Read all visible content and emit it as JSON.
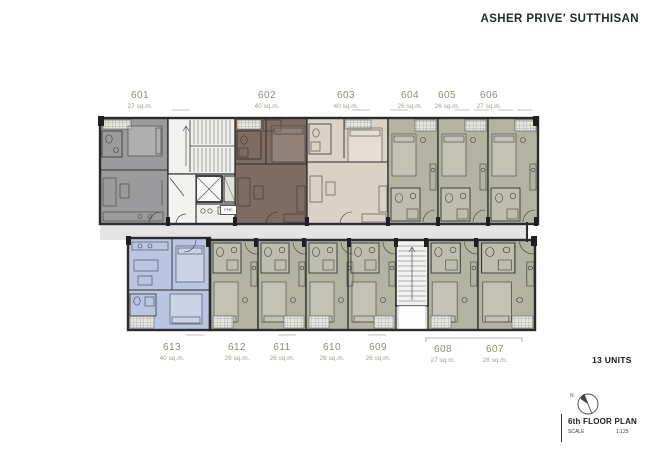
{
  "header": {
    "title": "ASHER PRIVE' SUTTHISAN"
  },
  "plan": {
    "fhc_label": "FHC",
    "units": [
      {
        "number": "601",
        "area": "27 sq.m."
      },
      {
        "number": "602",
        "area": "40 sq.m."
      },
      {
        "number": "603",
        "area": "40 sq.m."
      },
      {
        "number": "604",
        "area": "26 sq.m."
      },
      {
        "number": "605",
        "area": "26 sq.m."
      },
      {
        "number": "606",
        "area": "27 sq.m."
      },
      {
        "number": "607",
        "area": "28 sq.m."
      },
      {
        "number": "608",
        "area": "27 sq.m."
      },
      {
        "number": "609",
        "area": "26 sq.m."
      },
      {
        "number": "610",
        "area": "26 sq.m."
      },
      {
        "number": "611",
        "area": "26 sq.m."
      },
      {
        "number": "612",
        "area": "26 sq.m."
      },
      {
        "number": "613",
        "area": "40 sq.m."
      }
    ]
  },
  "compass": {
    "label": "N"
  },
  "footer": {
    "units_count": "13 UNITS",
    "plan_title": "6th FLOOR PLAN",
    "scale_label": "SCALE",
    "scale_value": "1:125"
  },
  "colors": {
    "unit_601": "#9b9b9d",
    "unit_602": "#7e6c62",
    "unit_603": "#d9d3c7",
    "unit_studio": "#b3b3a1",
    "unit_613": "#b9c5e1",
    "corridor": "#e4e4e2",
    "core": "#efefed",
    "walls": "#2b2b2b",
    "label_text": "#8d8d7b",
    "title_text": "#232b27"
  }
}
